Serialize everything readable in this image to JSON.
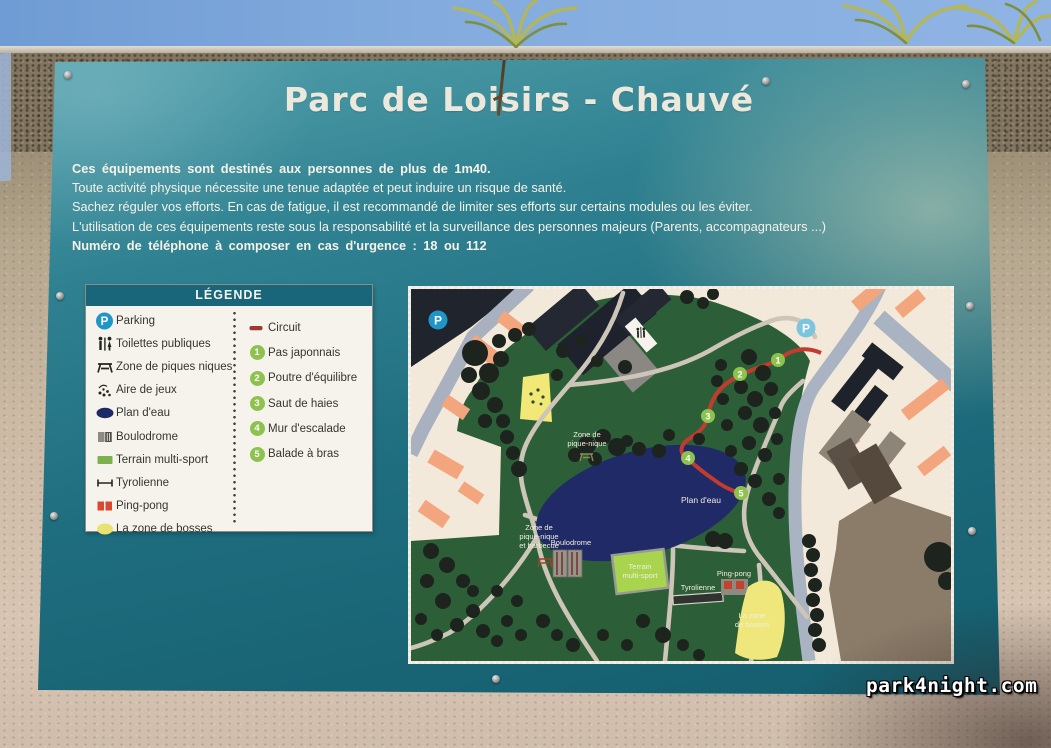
{
  "watermark": "park4night.com",
  "sign": {
    "title": "Parc de Loisirs - Chauvé",
    "parking_label": "P",
    "intro": {
      "lines": [
        "Ces équipements sont destinés aux personnes de plus de 1m40.",
        "Toute activité physique nécessite une tenue adaptée et peut induire un risque de santé.",
        "Sachez réguler vos efforts. En cas de fatigue, il est recommandé de limiter ses efforts sur certains modules ou les éviter.",
        "L'utilisation de ces équipements reste sous la responsabilité et la surveillance des personnes majeurs (Parents, accompagnateurs ...)",
        "Numéro de téléphone à composer en cas d'urgence : 18 ou 112"
      ]
    },
    "legend": {
      "header": "LÉGENDE",
      "left_items": [
        {
          "icon": "parking-icon",
          "label": "Parking"
        },
        {
          "icon": "toilets-icon",
          "label": "Toilettes publiques"
        },
        {
          "icon": "picnic-icon",
          "label": "Zone de piques niques"
        },
        {
          "icon": "playground-icon",
          "label": "Aire de jeux"
        },
        {
          "icon": "water-icon",
          "label": "Plan d'eau"
        },
        {
          "icon": "boulodrome-icon",
          "label": "Boulodrome"
        },
        {
          "icon": "multisport-icon",
          "label": "Terrain multi-sport"
        },
        {
          "icon": "zipline-icon",
          "label": "Tyrolienne"
        },
        {
          "icon": "pingpong-icon",
          "label": "Ping-pong"
        },
        {
          "icon": "bumps-icon",
          "label": "La zone de bosses"
        }
      ],
      "right_items": [
        {
          "icon": "circuit-icon",
          "label": "Circuit"
        },
        {
          "number": "1",
          "label": "Pas japonnais"
        },
        {
          "number": "2",
          "label": "Poutre d'équilibre"
        },
        {
          "number": "3",
          "label": "Saut de haies"
        },
        {
          "number": "4",
          "label": "Mur d'escalade"
        },
        {
          "number": "5",
          "label": "Balade à bras"
        }
      ]
    },
    "map": {
      "circuit_numbers": [
        "1",
        "2",
        "3",
        "4",
        "5"
      ],
      "labels": {
        "picnic_line1": "Zone de",
        "picnic_line2": "pique-nique",
        "picnic_bbq_line1": "Zone de",
        "picnic_bbq_line2": "pique-nique",
        "picnic_bbq_line3": "et barbecue",
        "plan_eau": "Plan d'eau",
        "boulodrome": "Boulodrome",
        "terrain_line1": "Terrain",
        "terrain_line2": "multi-sport",
        "tyrolienne": "Tyrolienne",
        "pingpong": "Ping-pong",
        "bosses_line1": "La zone",
        "bosses_line2": "de bosses"
      }
    }
  },
  "colors": {
    "panel_teal": "#1e6d7e",
    "legend_header_teal": "#19657a",
    "circuit_red": "#c13b30",
    "badge_green": "#8ec24f",
    "parking_blue": "#1f96c8",
    "lake_navy": "#1f2a66",
    "park_green": "#2c5f38",
    "map_cream": "#f3e9da",
    "building_salmon": "#f3a57e",
    "zone_yellow": "#efe77c",
    "multisport_green": "#a8d44e"
  }
}
